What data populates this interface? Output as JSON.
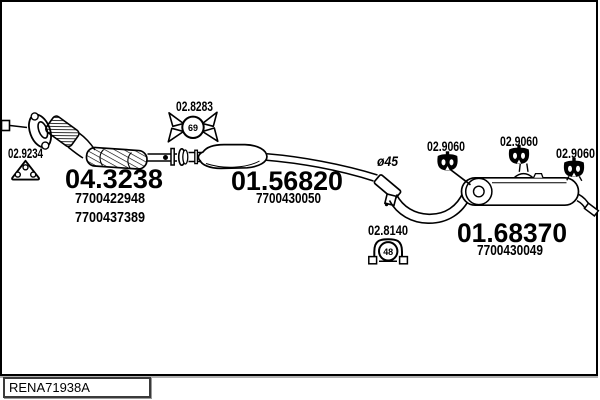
{
  "footer": {
    "catalog_code": "RENA71938A"
  },
  "diagram": {
    "pipe_diameter_label": "ø45",
    "line_color": "#000000",
    "background": "#ffffff",
    "parts": {
      "flange_gasket": {
        "code": "02.9234"
      },
      "front_pipe_catalyst": {
        "code": "04.3238",
        "oe_number_1": "7700422948",
        "oe_number_2": "7700437389"
      },
      "rubber_hanger": {
        "code": "02.8283",
        "diameter": "69"
      },
      "centre_silencer": {
        "code": "01.56820",
        "oe_number": "7700430050"
      },
      "pipe_clamp": {
        "code": "02.8140",
        "diameter": "48"
      },
      "rubber_mount_front": {
        "code": "02.9060"
      },
      "rubber_mount_mid": {
        "code": "02.9060"
      },
      "rubber_mount_rear": {
        "code": "02.9060"
      },
      "rear_silencer": {
        "code": "01.68370",
        "oe_number": "7700430049"
      }
    }
  }
}
